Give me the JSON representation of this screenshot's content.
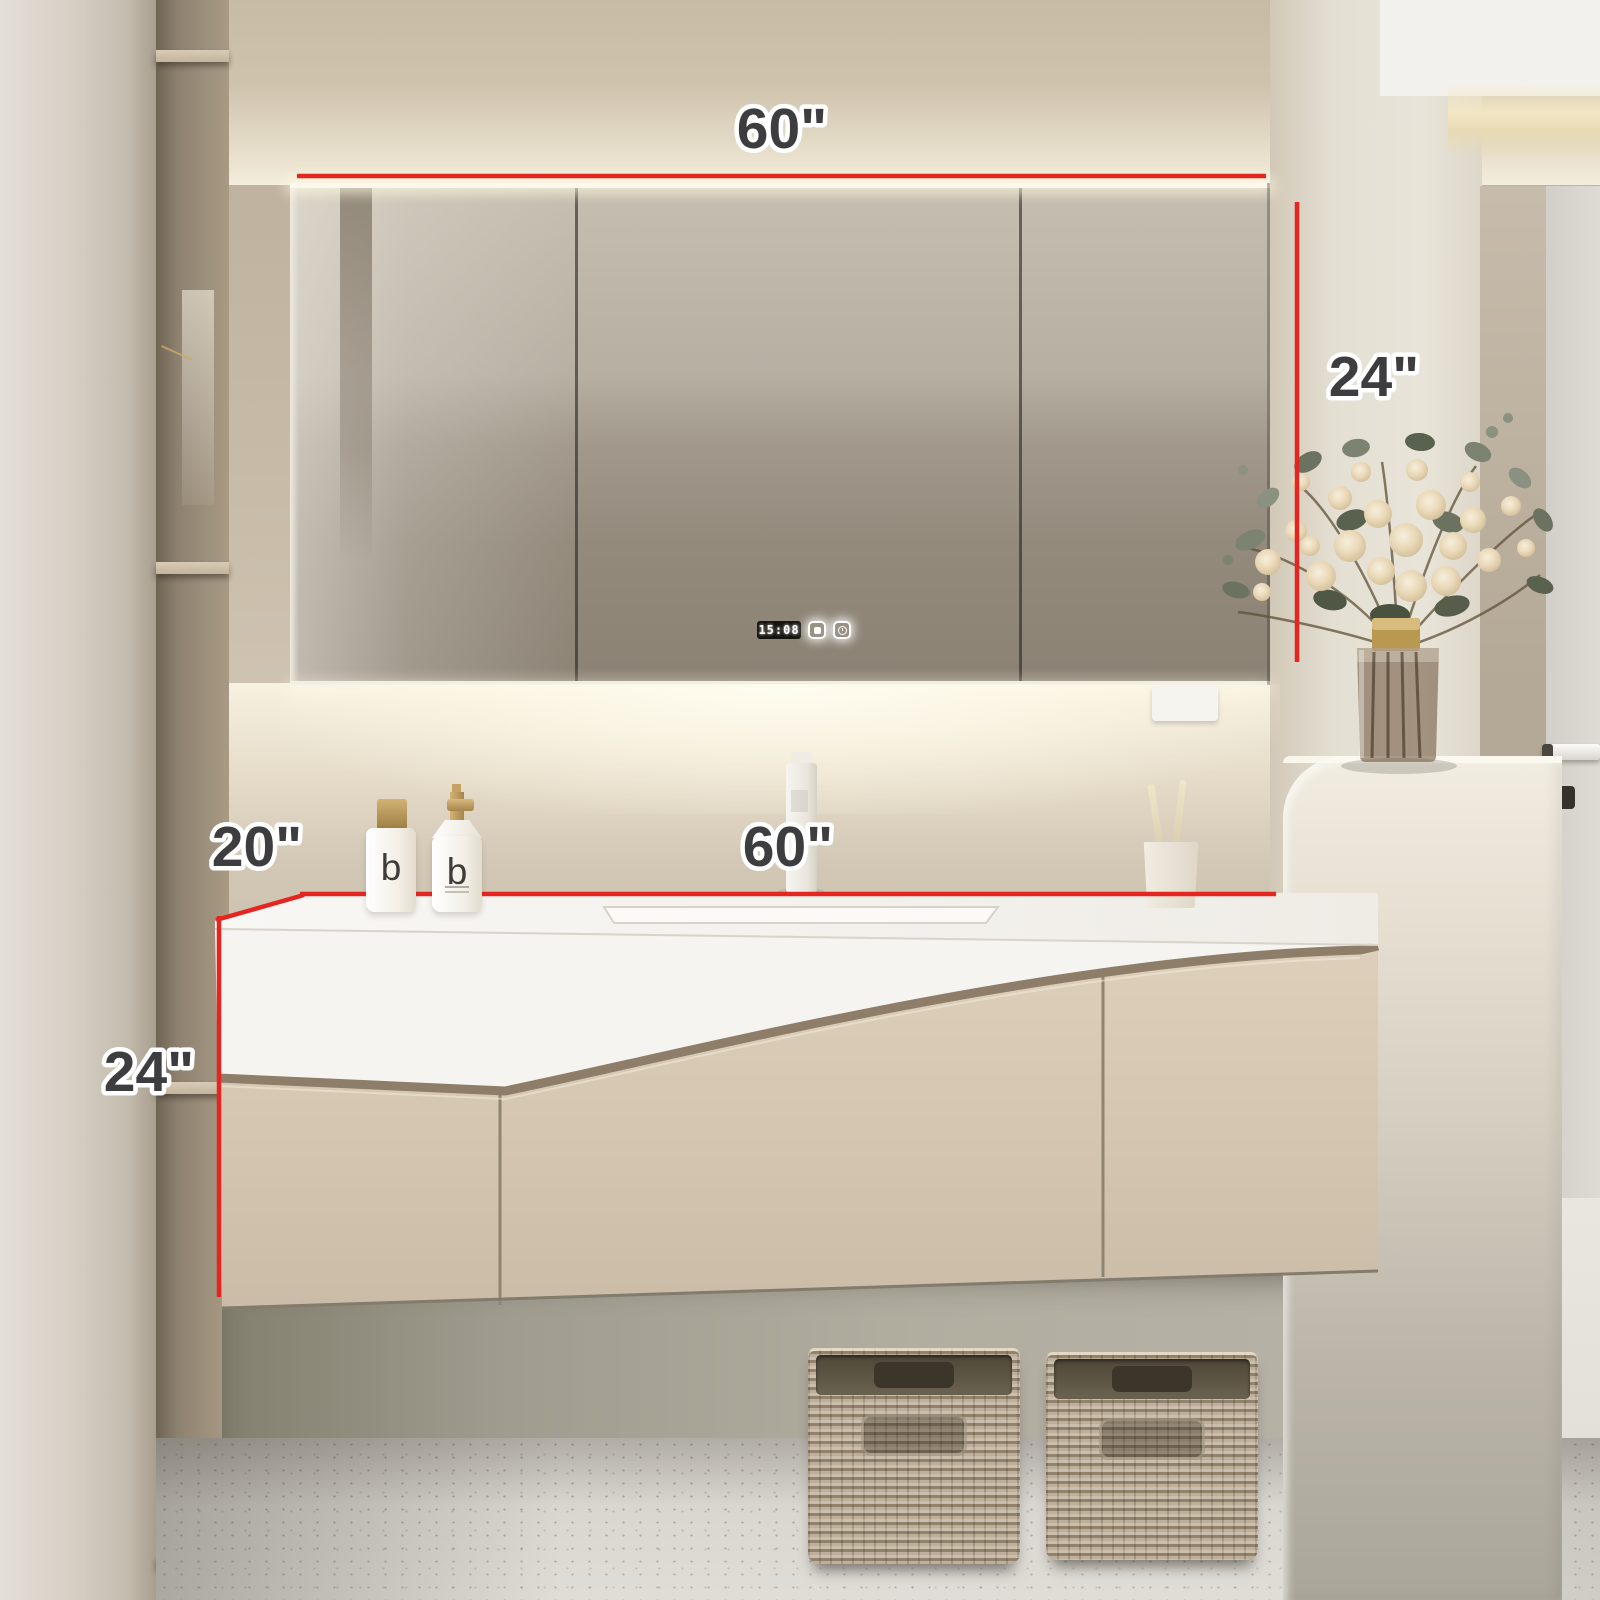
{
  "scene": {
    "description": "Bathroom vanity product photo with red dimension annotations",
    "dimensions": {
      "mirror_width": "60\"",
      "mirror_height": "24\"",
      "counter_depth": "20\"",
      "counter_width": "60\"",
      "vanity_height": "24\""
    },
    "mirror": {
      "clock_time": "15:08",
      "button_icons": [
        "defog-icon",
        "timer-icon"
      ]
    },
    "bottles": {
      "brand_letter": "b"
    },
    "colors": {
      "annotation_red": "#e52620",
      "label_gray": "#3d3d3f",
      "wall_beige": "#c7bba6",
      "cabinet_beige": "#d5c6b0",
      "counter_white": "#f6f5f2",
      "groove_bronze": "#8d7d69",
      "basket_wicker": "#b3a289",
      "gold_accent": "#c8a96b"
    }
  }
}
